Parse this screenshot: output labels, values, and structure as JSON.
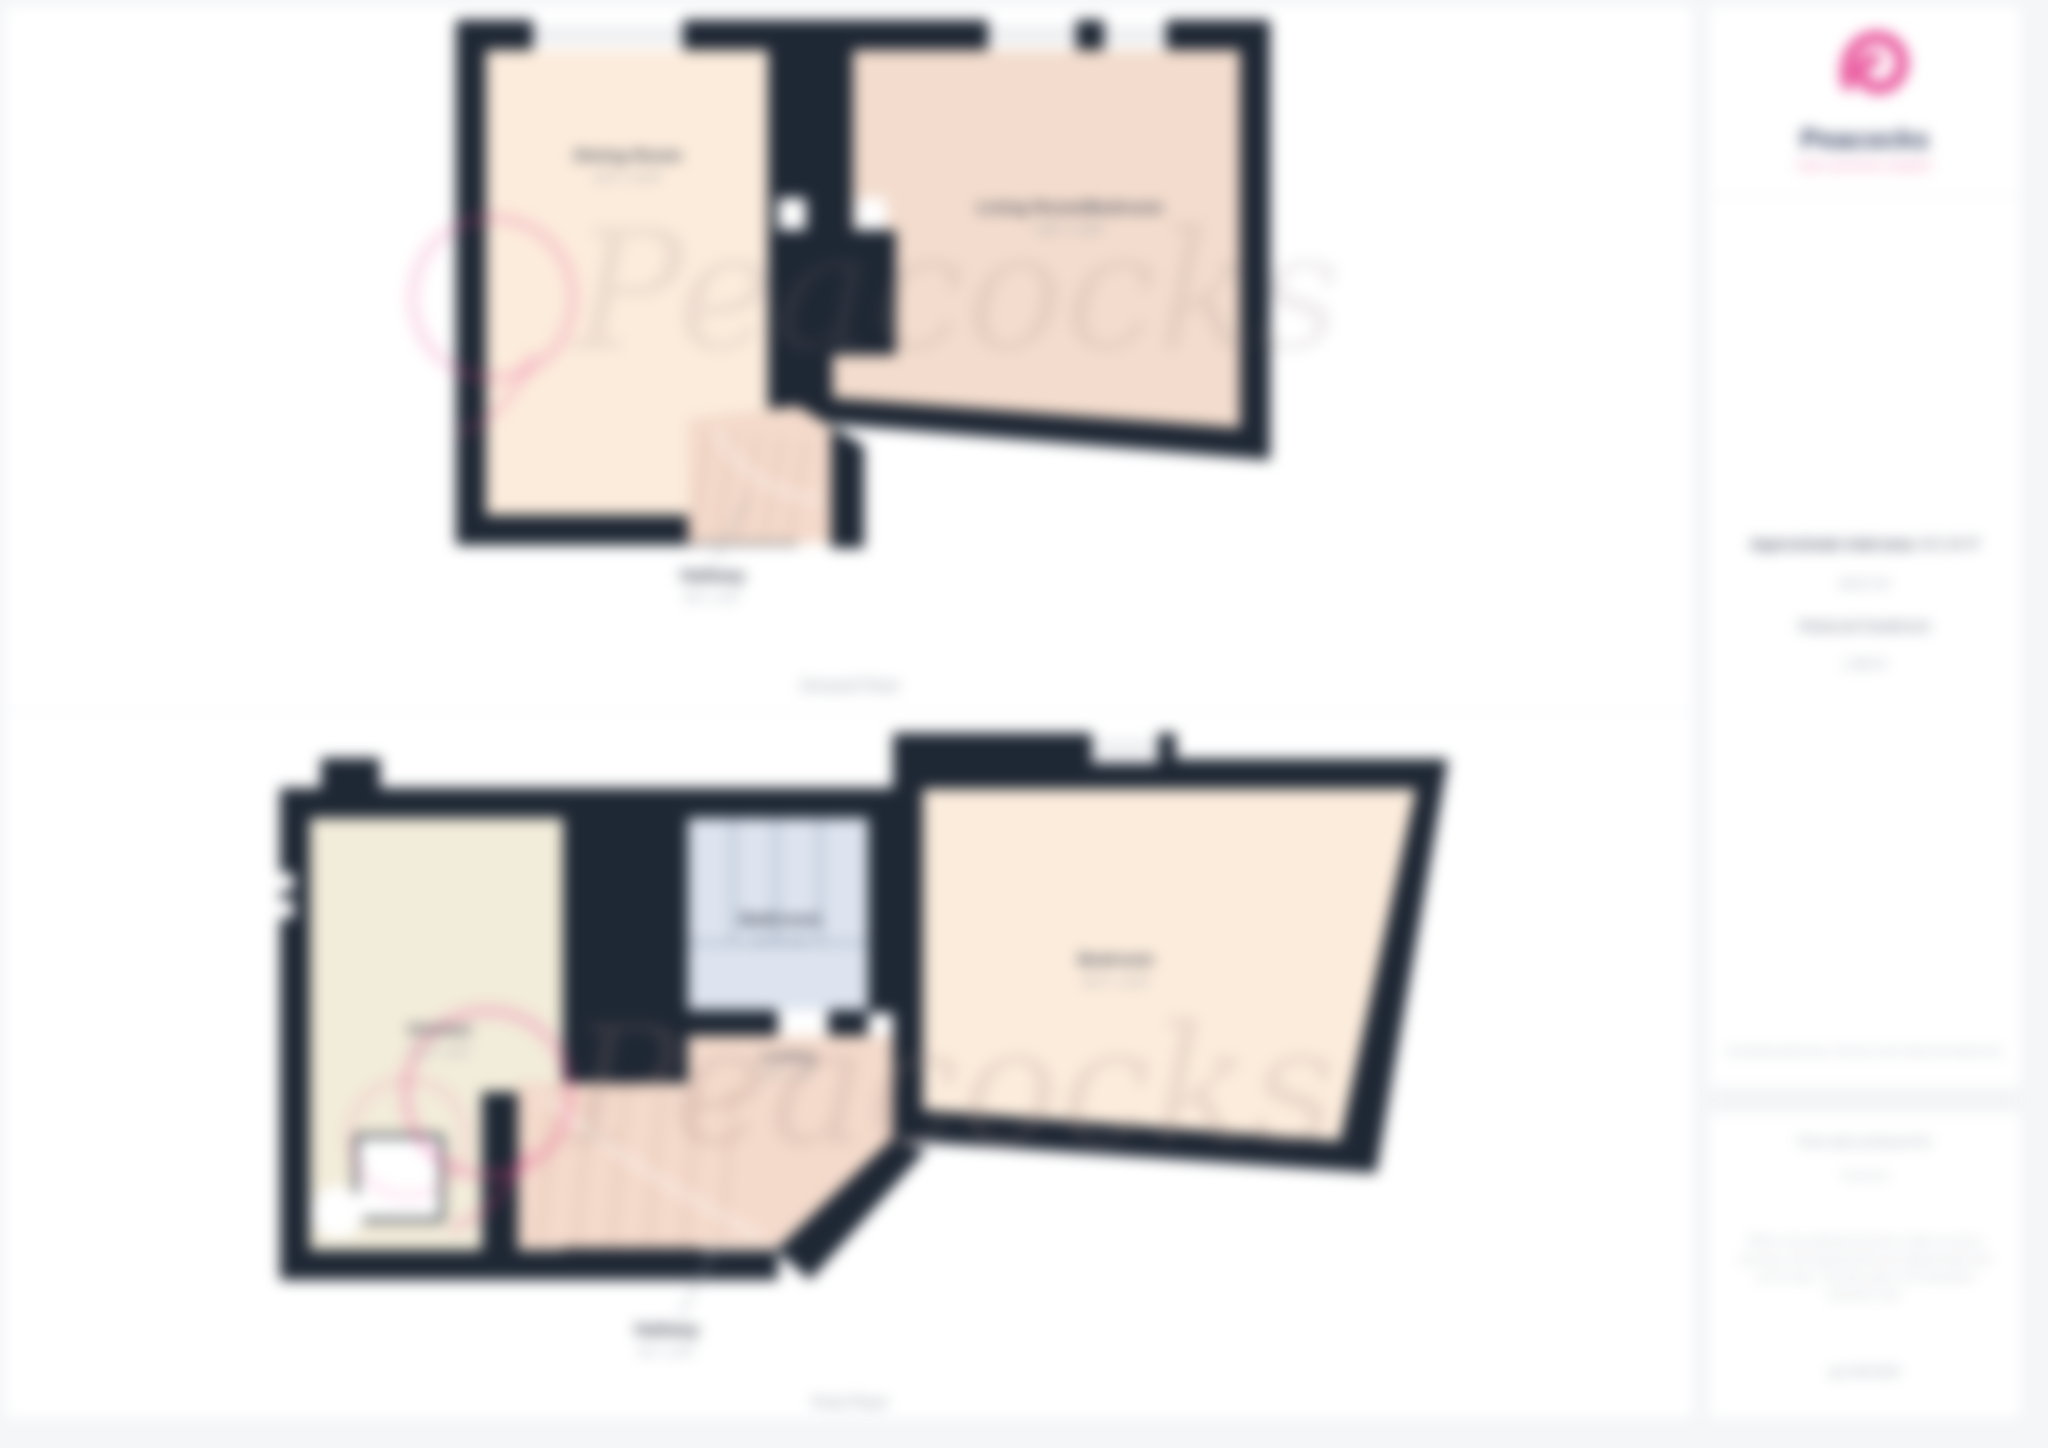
{
  "brand": {
    "name": "Peacocks",
    "tagline": "THE ESTATE AGENT",
    "accent_pink": "#e6417f",
    "navy": "#2e3a5c"
  },
  "sidebar": {
    "area_label": "Approximate total area",
    "area_value_ft": "433.48 ft²",
    "area_value_m": "40.27 m²",
    "headroom_label": "Reduced headroom",
    "headroom_value": "1.48 m²",
    "excluding_note": "Excluding balconies, terraces and reduced headrooms",
    "produced_for_label": "Floor plan produced for",
    "produced_for_value": "Peacocks",
    "disclaimer": "While every attempt has been made to ensure accuracy, all measurements are approximate and not to scale. This floor plan is for illustrative purposes only.",
    "generator": "giraffe360"
  },
  "watermark": {
    "text": "Peacocks"
  },
  "floors": [
    {
      "title": "Ground Floor",
      "rooms": [
        {
          "name": "Dining Room",
          "dims": "11'5\" x 10'3\""
        },
        {
          "name": "Living Room/Bedroom",
          "dims": "14'9\" x 10'6\""
        },
        {
          "name": "Hallway",
          "dims": "6'5\" x 3'2\""
        }
      ]
    },
    {
      "title": "First Floor",
      "rooms": [
        {
          "name": "Kitchen",
          "dims": "11'3\" x 8'9\""
        },
        {
          "name": "Bathroom",
          "dims": "8'1\" x 5'6\""
        },
        {
          "name": "Bedroom",
          "dims": "15'2\" x 11'8\""
        },
        {
          "name": "Landing",
          "dims": "5'9\" x 2'8\""
        },
        {
          "name": "Hallway",
          "dims": "6'1\" x 3'0\""
        }
      ]
    }
  ]
}
